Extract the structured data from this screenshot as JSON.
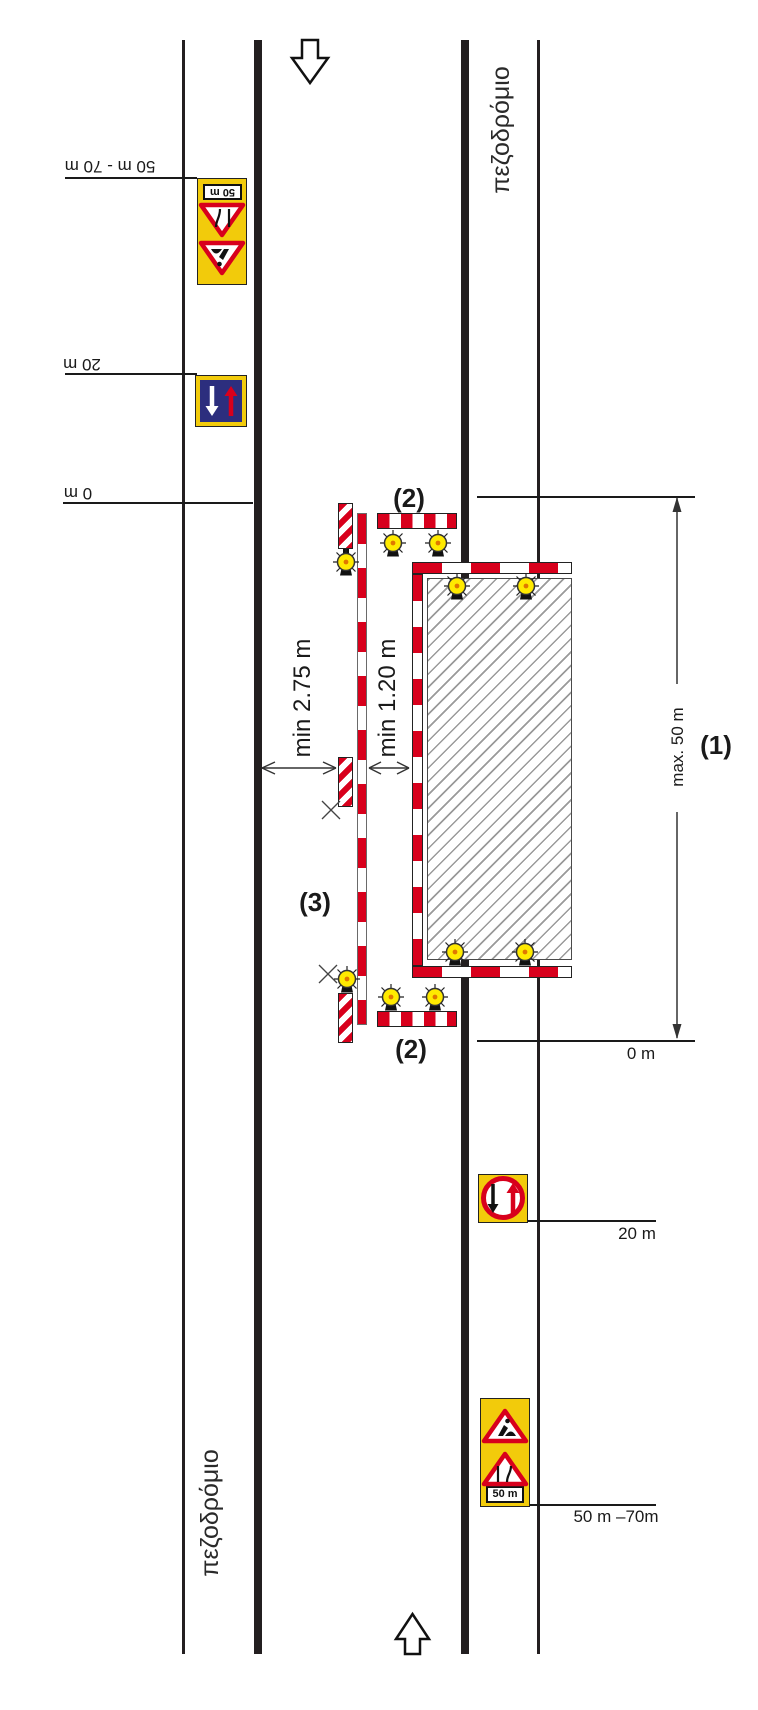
{
  "colors": {
    "red": "#d8001c",
    "sign_yellow": "#f2cb0b",
    "lamp_yellow": "#ffea00",
    "blue": "#2c2e7e",
    "line_black": "#231f20",
    "hatch_gray": "#9a9a9a"
  },
  "sidewalk": {
    "left_label": "πεζοδρόμιο",
    "right_label": "πεζοδρόμιο"
  },
  "zone_labels": {
    "l1": "(1)",
    "l2_top": "(2)",
    "l2_bottom": "(2)",
    "l3": "(3)"
  },
  "dimensions": {
    "min_lane": "min 2.75 m",
    "min_offset": "min 1.20 m",
    "max_zone": "max. 50 m"
  },
  "approach_top": {
    "d0": "0 m",
    "d20": "20 m",
    "d50": "50 m - 70 m",
    "plate": "50 m"
  },
  "approach_bottom": {
    "d0": "0 m",
    "d20": "20 m",
    "d50": "50 m –70m",
    "plate": "50 m"
  }
}
